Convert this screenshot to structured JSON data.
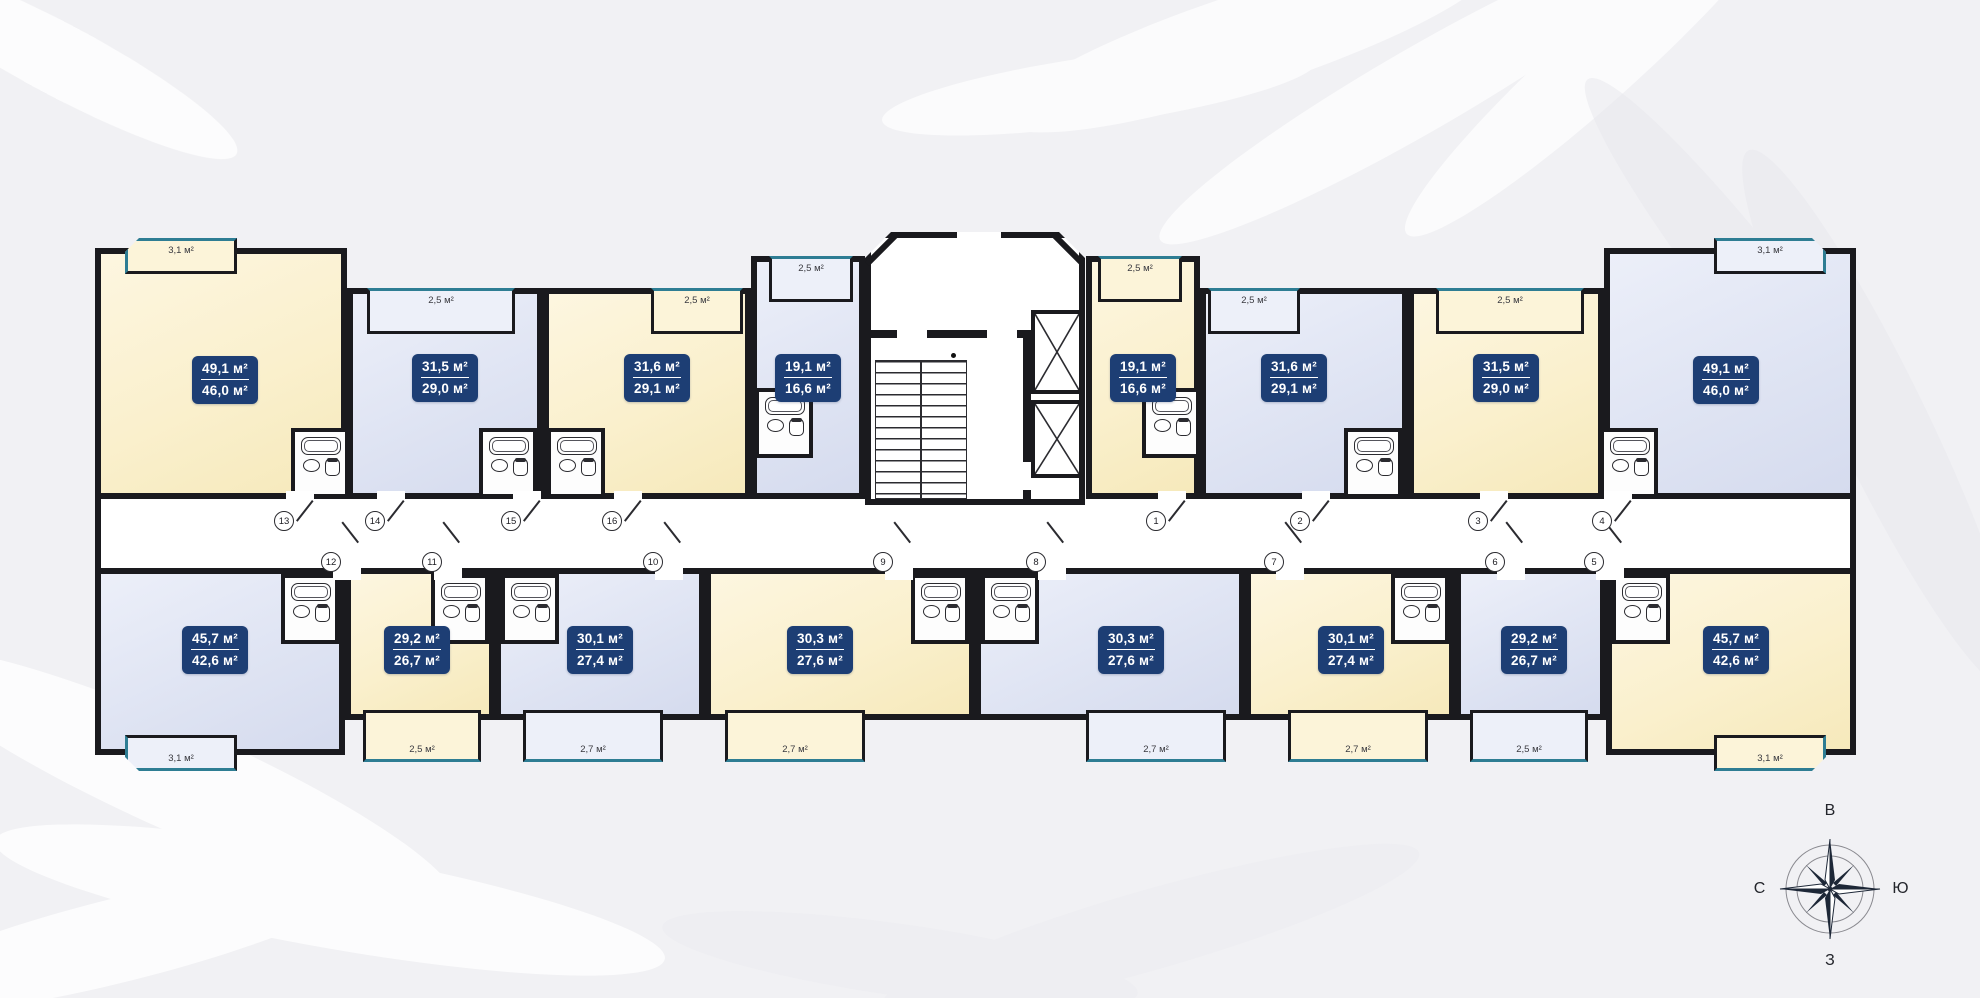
{
  "plan_name": "floor-plan",
  "compass": {
    "top": "В",
    "right": "Ю",
    "bottom": "З",
    "left": "С"
  },
  "apartments": [
    {
      "id": "t1",
      "door_number": "13",
      "area_total": "49,1 м²",
      "area_living": "46,0 м²",
      "balcony_area": "3,1 м²",
      "variant": "yellow",
      "row": "top"
    },
    {
      "id": "t2",
      "door_number": "14",
      "area_total": "31,5 м²",
      "area_living": "29,0 м²",
      "balcony_area": "2,5 м²",
      "variant": "blue",
      "row": "top"
    },
    {
      "id": "t3",
      "door_number": "15",
      "area_total": "31,6 м²",
      "area_living": "29,1 м²",
      "balcony_area": "2,5 м²",
      "variant": "yellow",
      "row": "top"
    },
    {
      "id": "t4",
      "door_number": "16",
      "area_total": "19,1 м²",
      "area_living": "16,6 м²",
      "balcony_area": "2,5 м²",
      "variant": "blue",
      "row": "top"
    },
    {
      "id": "t5",
      "door_number": "1",
      "area_total": "19,1 м²",
      "area_living": "16,6 м²",
      "balcony_area": "2,5 м²",
      "variant": "yellow",
      "row": "top"
    },
    {
      "id": "t6",
      "door_number": "2",
      "area_total": "31,6 м²",
      "area_living": "29,1 м²",
      "balcony_area": "2,5 м²",
      "variant": "blue",
      "row": "top"
    },
    {
      "id": "t7",
      "door_number": "3",
      "area_total": "31,5 м²",
      "area_living": "29,0 м²",
      "balcony_area": "2,5 м²",
      "variant": "yellow",
      "row": "top"
    },
    {
      "id": "t8",
      "door_number": "4",
      "area_total": "49,1 м²",
      "area_living": "46,0 м²",
      "balcony_area": "3,1 м²",
      "variant": "blue",
      "row": "top"
    },
    {
      "id": "b1",
      "door_number": "12",
      "area_total": "45,7 м²",
      "area_living": "42,6 м²",
      "balcony_area": "3,1 м²",
      "variant": "blue",
      "row": "bottom"
    },
    {
      "id": "b2",
      "door_number": "11",
      "area_total": "29,2 м²",
      "area_living": "26,7 м²",
      "balcony_area": "2,5 м²",
      "variant": "yellow",
      "row": "bottom"
    },
    {
      "id": "b3",
      "door_number": "10",
      "area_total": "30,1 м²",
      "area_living": "27,4 м²",
      "balcony_area": "2,7 м²",
      "variant": "blue",
      "row": "bottom"
    },
    {
      "id": "b4",
      "door_number": "9",
      "area_total": "30,3 м²",
      "area_living": "27,6 м²",
      "balcony_area": "2,7 м²",
      "variant": "yellow",
      "row": "bottom"
    },
    {
      "id": "b5",
      "door_number": "8",
      "area_total": "30,3 м²",
      "area_living": "27,6 м²",
      "balcony_area": "2,7 м²",
      "variant": "blue",
      "row": "bottom"
    },
    {
      "id": "b6",
      "door_number": "7",
      "area_total": "30,1 м²",
      "area_living": "27,4 м²",
      "balcony_area": "2,7 м²",
      "variant": "yellow",
      "row": "bottom"
    },
    {
      "id": "b7",
      "door_number": "6",
      "area_total": "29,2 м²",
      "area_living": "26,7 м²",
      "balcony_area": "2,5 м²",
      "variant": "blue",
      "row": "bottom"
    },
    {
      "id": "b8",
      "door_number": "5",
      "area_total": "45,7 м²",
      "area_living": "42,6 м²",
      "balcony_area": "3,1 м²",
      "variant": "yellow",
      "row": "bottom"
    }
  ]
}
